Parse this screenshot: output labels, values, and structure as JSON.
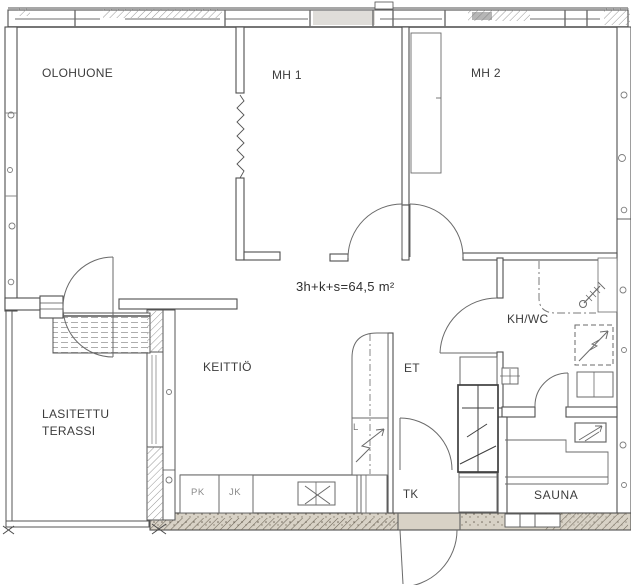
{
  "floor_plan": {
    "area_label": "3h+k+s=64,5 m²",
    "rooms": {
      "living": "OLOHUONE",
      "bedroom1": "MH 1",
      "bedroom2": "MH 2",
      "kitchen": "KEITTIÖ",
      "bathroom": "KH/WC",
      "hall": "ET",
      "vestibule": "TK",
      "sauna": "SAUNA",
      "terrace_line1": "LASITETTU",
      "terrace_line2": "TERASSI"
    },
    "appliances": {
      "freezer": "PK",
      "fridge": "JK",
      "electric_panel": "L"
    },
    "colors": {
      "ink": "#4f4f4f",
      "paper": "#ffffff",
      "wall_fill": "#d8d2c6"
    }
  }
}
